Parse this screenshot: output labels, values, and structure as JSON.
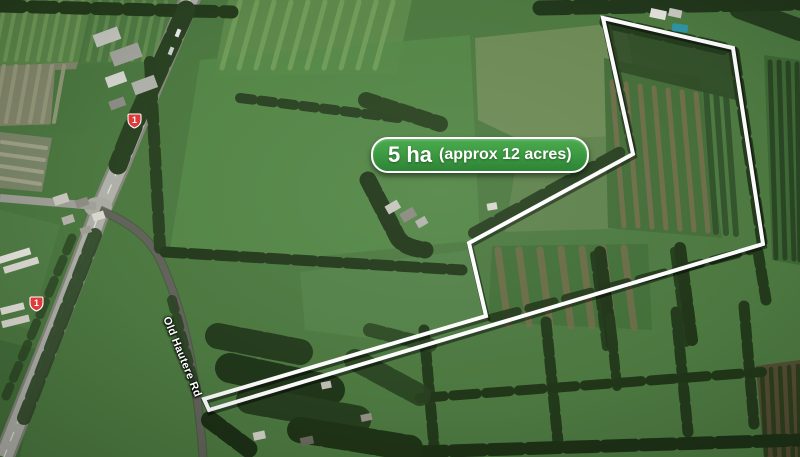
{
  "map": {
    "description": "Aerial satellite photo of rural property for sale",
    "area_label": {
      "value": "5 ha",
      "qualifier": "(approx 12 acres)"
    },
    "road_label": "Old Hautere Rd",
    "route_markers": [
      {
        "number": "1"
      },
      {
        "number": "1"
      }
    ],
    "boundary": {
      "color": "#ffffff",
      "points": [
        [
          603,
          18
        ],
        [
          733,
          48
        ],
        [
          763,
          244
        ],
        [
          209,
          410
        ],
        [
          204,
          399
        ],
        [
          486,
          316
        ],
        [
          469,
          243
        ],
        [
          633,
          154
        ]
      ]
    },
    "colors": {
      "label_green": "#3d9b42",
      "marker_red": "#e03b3b",
      "field_green": "#4e7b42",
      "hedge_dark": "#243b1c",
      "highway_grey": "#b2b3ac"
    }
  }
}
